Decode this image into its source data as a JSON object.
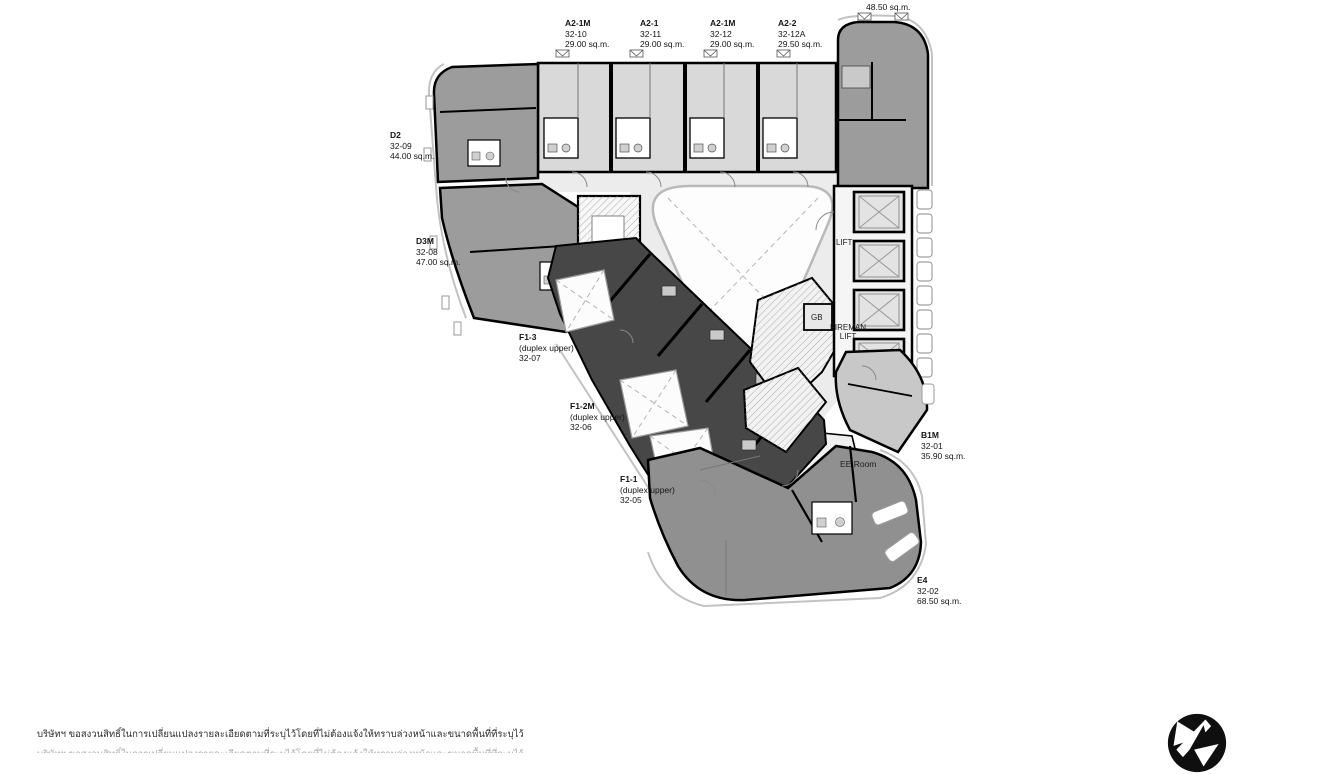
{
  "colors": {
    "light_unit": "#d9d9d9",
    "mid_unit": "#9c9c9c",
    "dark_unit": "#474747",
    "corridor": "#ececec",
    "lobby": "#f5f5f5",
    "unit_b1m": "#c8c8c8",
    "wall": "#000000",
    "logo": "#0f0f0f"
  },
  "units": [
    {
      "l1": "A2-1M",
      "l2": "32-10",
      "l3": "29.00 sq.m."
    },
    {
      "l1": "A2-1",
      "l2": "32-11",
      "l3": "29.00 sq.m."
    },
    {
      "l1": "A2-1M",
      "l2": "32-12",
      "l3": "29.00 sq.m."
    },
    {
      "l1": "A2-2",
      "l2": "32-12A",
      "l3": "29.50 sq.m."
    },
    {
      "l1": "32-14",
      "l2": "48.50 sq.m.",
      "l3": ""
    },
    {
      "l1": "D2",
      "l2": "32-09",
      "l3": "44.00 sq.m."
    },
    {
      "l1": "D3M",
      "l2": "32-08",
      "l3": "47.00 sq.m."
    },
    {
      "l1": "F1-3",
      "l2": "(duplex upper)",
      "l3": "32-07"
    },
    {
      "l1": "F1-2M",
      "l2": "(duplex upper)",
      "l3": "32-06"
    },
    {
      "l1": "F1-1",
      "l2": "(duplex upper)",
      "l3": "32-05"
    },
    {
      "l1": "B1M",
      "l2": "32-01",
      "l3": "35.90 sq.m."
    },
    {
      "l1": "E4",
      "l2": "32-02",
      "l3": "68.50 sq.m."
    }
  ],
  "rooms": {
    "lift": "LIFT",
    "gb": "GB",
    "fireman_line1": "FIREMAN",
    "fireman_line2": "LIFT",
    "ee_room": "EE Room"
  },
  "footer": {
    "disclaimer": "บริษัทฯ ขอสงวนสิทธิ์ในการเปลี่ยนแปลงรายละเอียดตามที่ระบุไว้โดยที่ไม่ต้องแจ้งให้ทราบล่วงหน้าและขนาดพื้นที่ที่ระบุไว้"
  }
}
